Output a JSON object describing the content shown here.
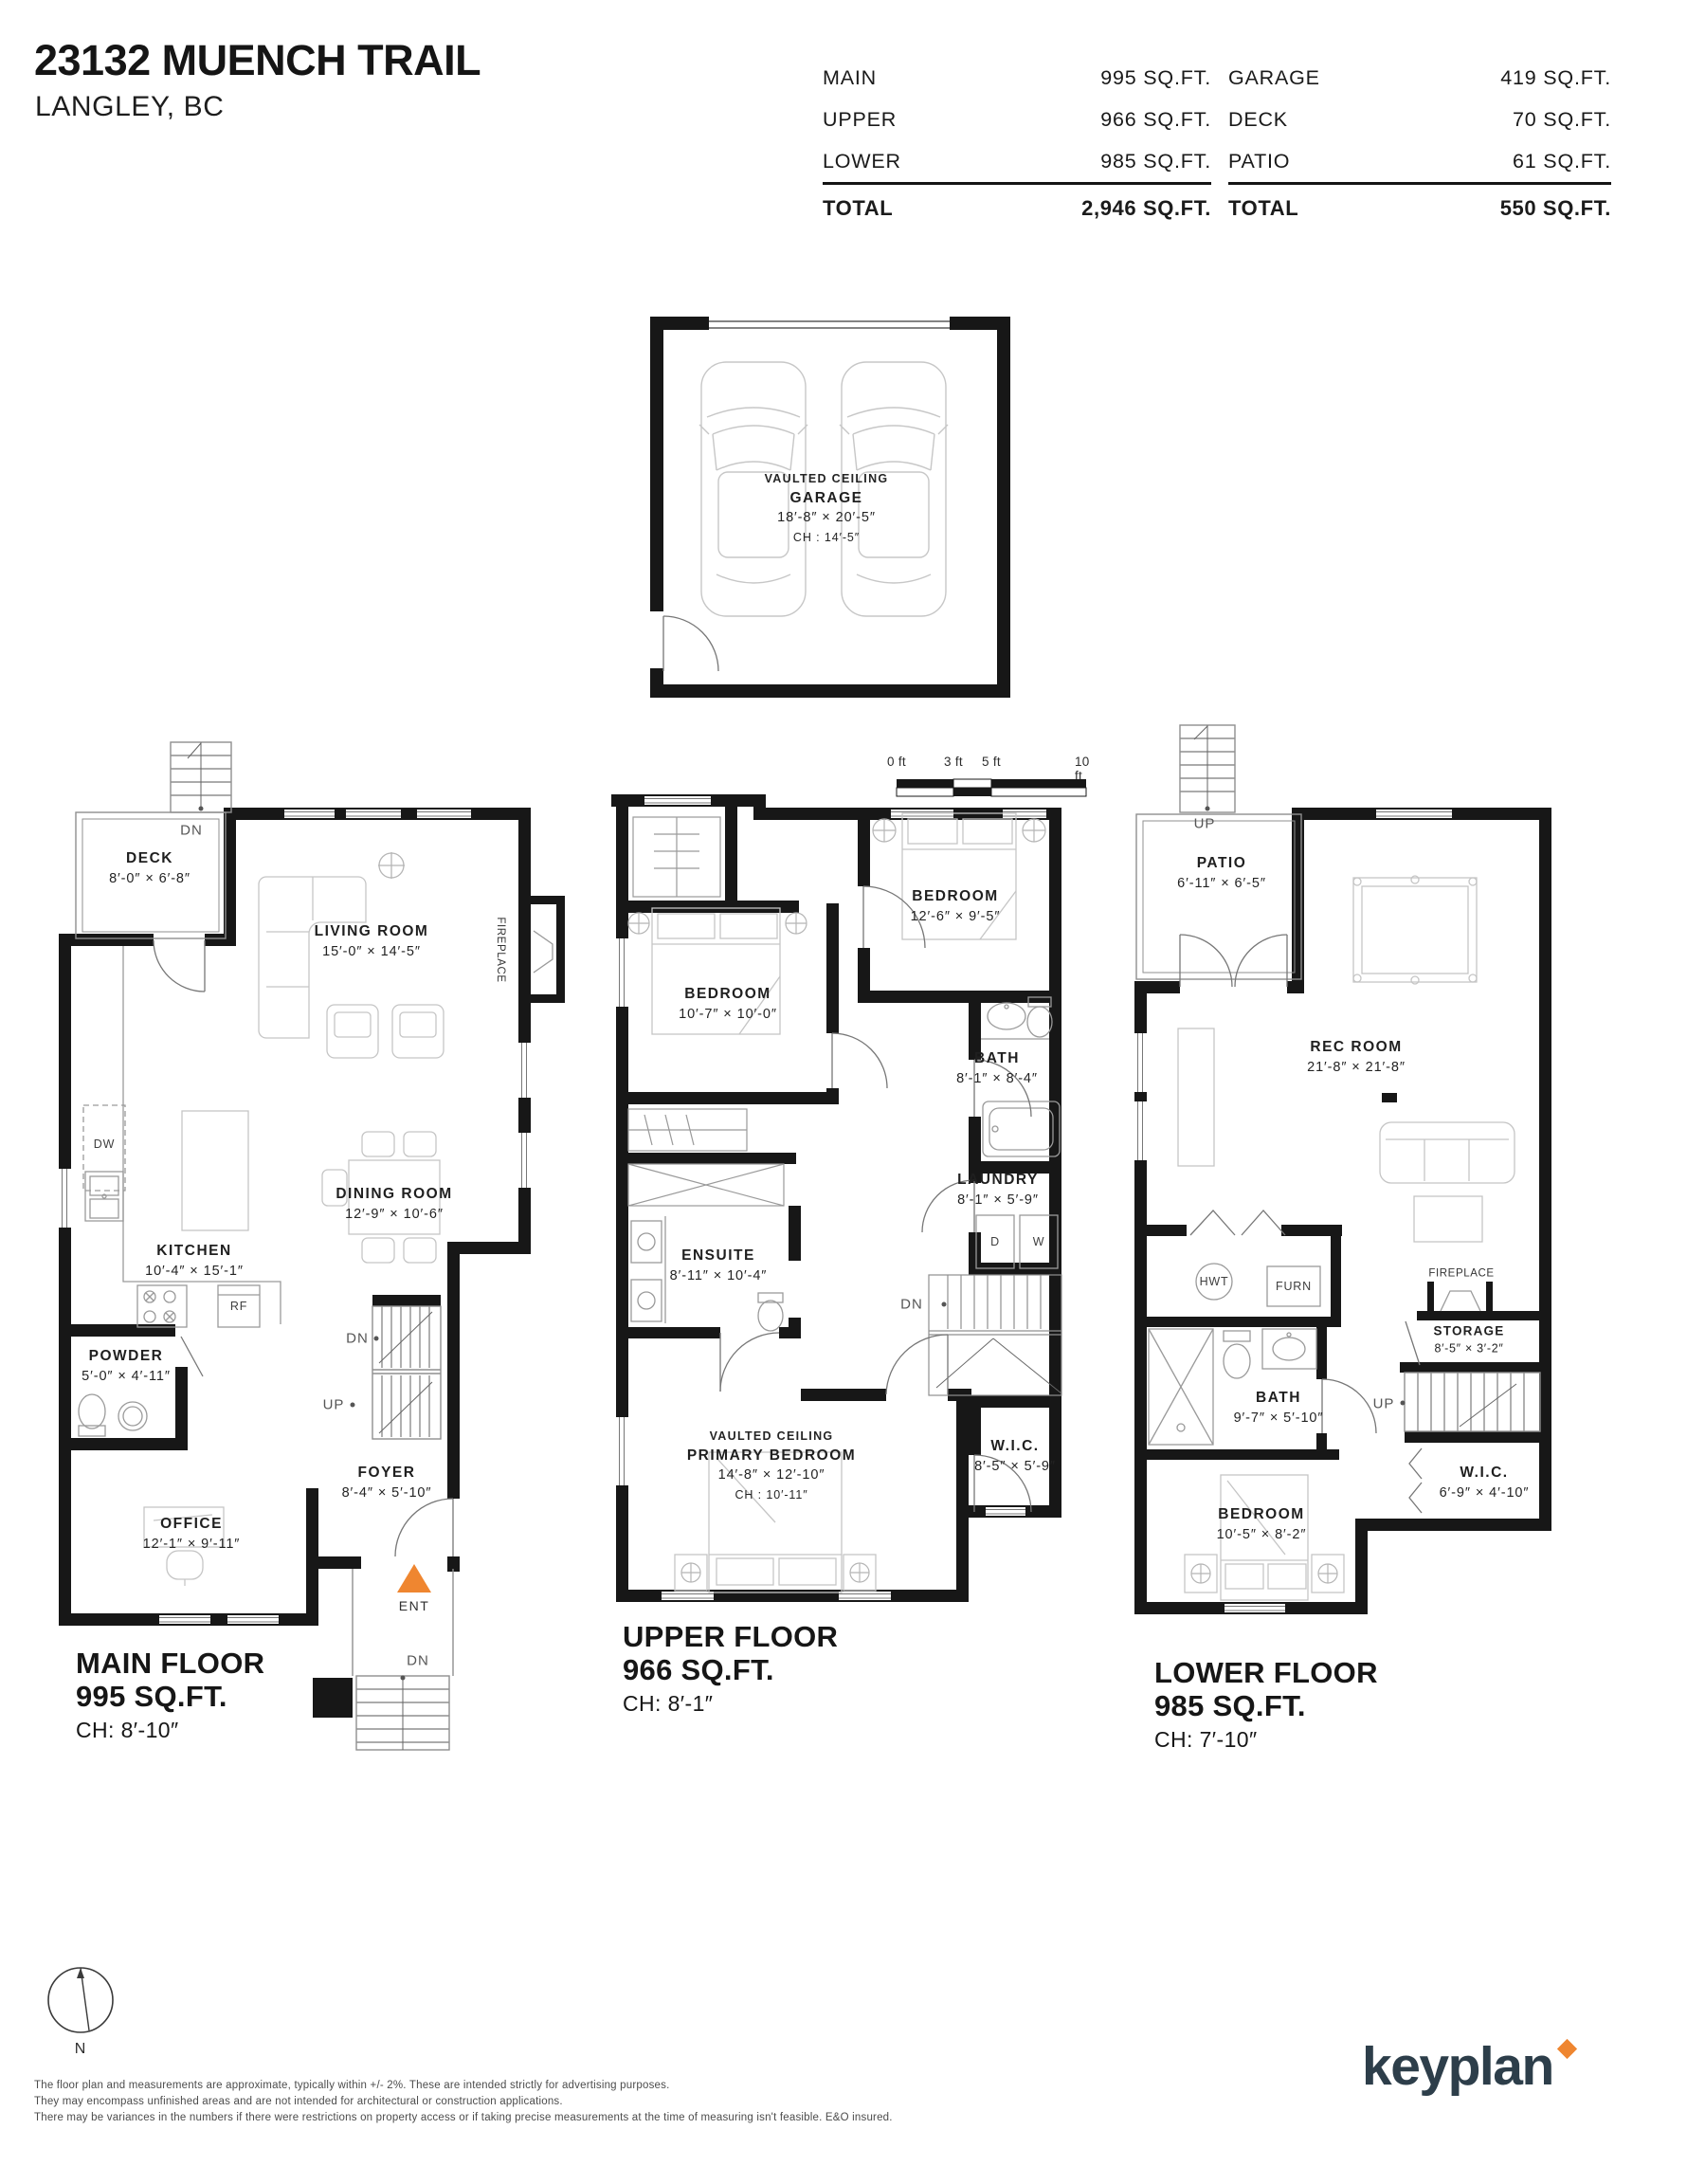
{
  "header": {
    "address": "23132 MUENCH TRAIL",
    "city": "LANGLEY, BC",
    "floor_table": {
      "rows": [
        {
          "label": "MAIN",
          "value": "995 SQ.FT."
        },
        {
          "label": "UPPER",
          "value": "966 SQ.FT."
        },
        {
          "label": "LOWER",
          "value": "985 SQ.FT."
        }
      ],
      "total": {
        "label": "TOTAL",
        "value": "2,946 SQ.FT."
      }
    },
    "extras_table": {
      "rows": [
        {
          "label": "GARAGE",
          "value": "419 SQ.FT."
        },
        {
          "label": "DECK",
          "value": "70 SQ.FT."
        },
        {
          "label": "PATIO",
          "value": "61 SQ.FT."
        }
      ],
      "total": {
        "label": "TOTAL",
        "value": "550 SQ.FT."
      }
    }
  },
  "garage_plan": {
    "note": "VAULTED CEILING",
    "name": "GARAGE",
    "dims": "18′-8″ × 20′-5″",
    "ch": "CH : 14′-5″"
  },
  "scale_bar": {
    "ticks": [
      "0 ft",
      "3 ft",
      "5 ft",
      "10 ft"
    ]
  },
  "labels": {
    "dn": "DN",
    "up": "UP",
    "ent": "ENT",
    "dw": "DW",
    "rf": "RF",
    "d": "D",
    "w": "W",
    "hwt": "HWT",
    "furn": "FURN",
    "fireplace": "FIREPLACE"
  },
  "main_floor": {
    "title": "MAIN FLOOR",
    "area": "995 SQ.FT.",
    "ch": "CH: 8′-10″",
    "rooms": {
      "deck": {
        "name": "DECK",
        "dims": "8′-0″ × 6′-8″"
      },
      "living": {
        "name": "LIVING ROOM",
        "dims": "15′-0″ × 14′-5″"
      },
      "dining": {
        "name": "DINING ROOM",
        "dims": "12′-9″ × 10′-6″"
      },
      "kitchen": {
        "name": "KITCHEN",
        "dims": "10′-4″ × 15′-1″"
      },
      "powder": {
        "name": "POWDER",
        "dims": "5′-0″ × 4′-11″"
      },
      "foyer": {
        "name": "FOYER",
        "dims": "8′-4″ × 5′-10″"
      },
      "office": {
        "name": "OFFICE",
        "dims": "12′-1″ × 9′-11″"
      }
    }
  },
  "upper_floor": {
    "title": "UPPER FLOOR",
    "area": "966 SQ.FT.",
    "ch": "CH: 8′-1″",
    "rooms": {
      "bedroom_right": {
        "name": "BEDROOM",
        "dims": "12′-6″ × 9′-5″"
      },
      "bedroom_left": {
        "name": "BEDROOM",
        "dims": "10′-7″ × 10′-0″"
      },
      "bath": {
        "name": "BATH",
        "dims": "8′-1″ × 8′-4″"
      },
      "laundry": {
        "name": "LAUNDRY",
        "dims": "8′-1″ × 5′-9″"
      },
      "ensuite": {
        "name": "ENSUITE",
        "dims": "8′-11″ × 10′-4″"
      },
      "primary": {
        "note": "VAULTED CEILING",
        "name": "PRIMARY BEDROOM",
        "dims": "14′-8″ × 12′-10″",
        "ch": "CH : 10′-11″"
      },
      "wic": {
        "name": "W.I.C.",
        "dims": "8′-5″ × 5′-9″"
      }
    }
  },
  "lower_floor": {
    "title": "LOWER FLOOR",
    "area": "985 SQ.FT.",
    "ch": "CH: 7′-10″",
    "rooms": {
      "patio": {
        "name": "PATIO",
        "dims": "6′-11″ × 6′-5″"
      },
      "rec": {
        "name": "REC ROOM",
        "dims": "21′-8″ × 21′-8″"
      },
      "storage": {
        "name": "STORAGE",
        "dims": "8′-5″ × 3′-2″"
      },
      "bath": {
        "name": "BATH",
        "dims": "9′-7″ × 5′-10″"
      },
      "wic": {
        "name": "W.I.C.",
        "dims": "6′-9″ × 4′-10″"
      },
      "bedroom": {
        "name": "BEDROOM",
        "dims": "10′-5″ × 8′-2″"
      }
    }
  },
  "compass": {
    "north": "N"
  },
  "footer": {
    "disclaimer": [
      "The floor plan and measurements are approximate, typically within +/- 2%. These are intended strictly for advertising purposes.",
      "They may encompass unfinished areas and are not intended for architectural or construction applications.",
      "There may be variances in the numbers if there were restrictions on property access or if taking precise measurements at the time of measuring isn't feasible. E&O insured."
    ],
    "brand": "keyplan"
  },
  "colors": {
    "accent_orange": "#EF8630",
    "brand_navy": "#2C3E49",
    "wall_ink": "#171717"
  }
}
